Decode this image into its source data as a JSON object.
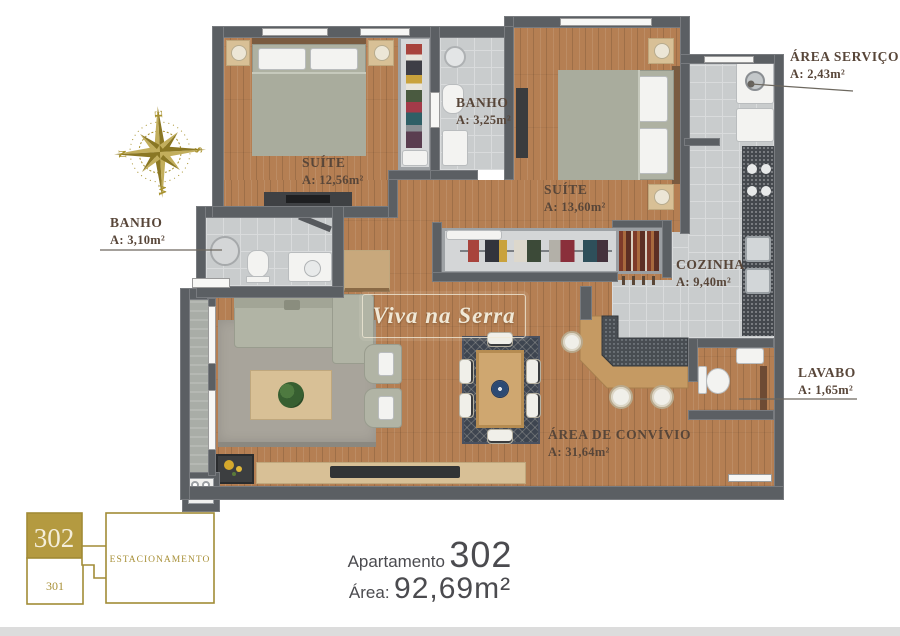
{
  "logo": {
    "text": "Viva na Serra"
  },
  "compass": {
    "directions": [
      "N",
      "E",
      "S",
      "W"
    ]
  },
  "rooms": [
    {
      "key": "suite-1",
      "name": "SUÍTE",
      "area": "A: 12,56m²"
    },
    {
      "key": "banho-suites",
      "name": "BANHO",
      "area": "A: 3,25m²"
    },
    {
      "key": "suite-2",
      "name": "SUÍTE",
      "area": "A: 13,60m²"
    },
    {
      "key": "area-servico",
      "name": "ÁREA SERVIÇO",
      "area": "A: 2,43m²"
    },
    {
      "key": "banho-social",
      "name": "BANHO",
      "area": "A: 3,10m²"
    },
    {
      "key": "cozinha",
      "name": "COZINHA",
      "area": "A: 9,40m²"
    },
    {
      "key": "lavabo",
      "name": "LAVABO",
      "area": "A: 1,65m²"
    },
    {
      "key": "area-convivio",
      "name": "ÁREA DE CONVÍVIO",
      "area": "A: 31,64m²"
    }
  ],
  "keyplan": {
    "highlight_unit": "302",
    "other_unit": "301",
    "parking_label": "ESTACIONAMENTO"
  },
  "title": {
    "prefix": "Apartamento",
    "number": "302",
    "area_label": "Área:",
    "area_value": "92,69m²"
  },
  "colors": {
    "gold": "#ab9338",
    "wall": "#5b5f63",
    "wood_floor": "#b57f53",
    "tile_floor": "#c9cccd",
    "label_text": "#584639",
    "title_text": "#4b4b4f",
    "logo_text": "#f0e8d6"
  }
}
